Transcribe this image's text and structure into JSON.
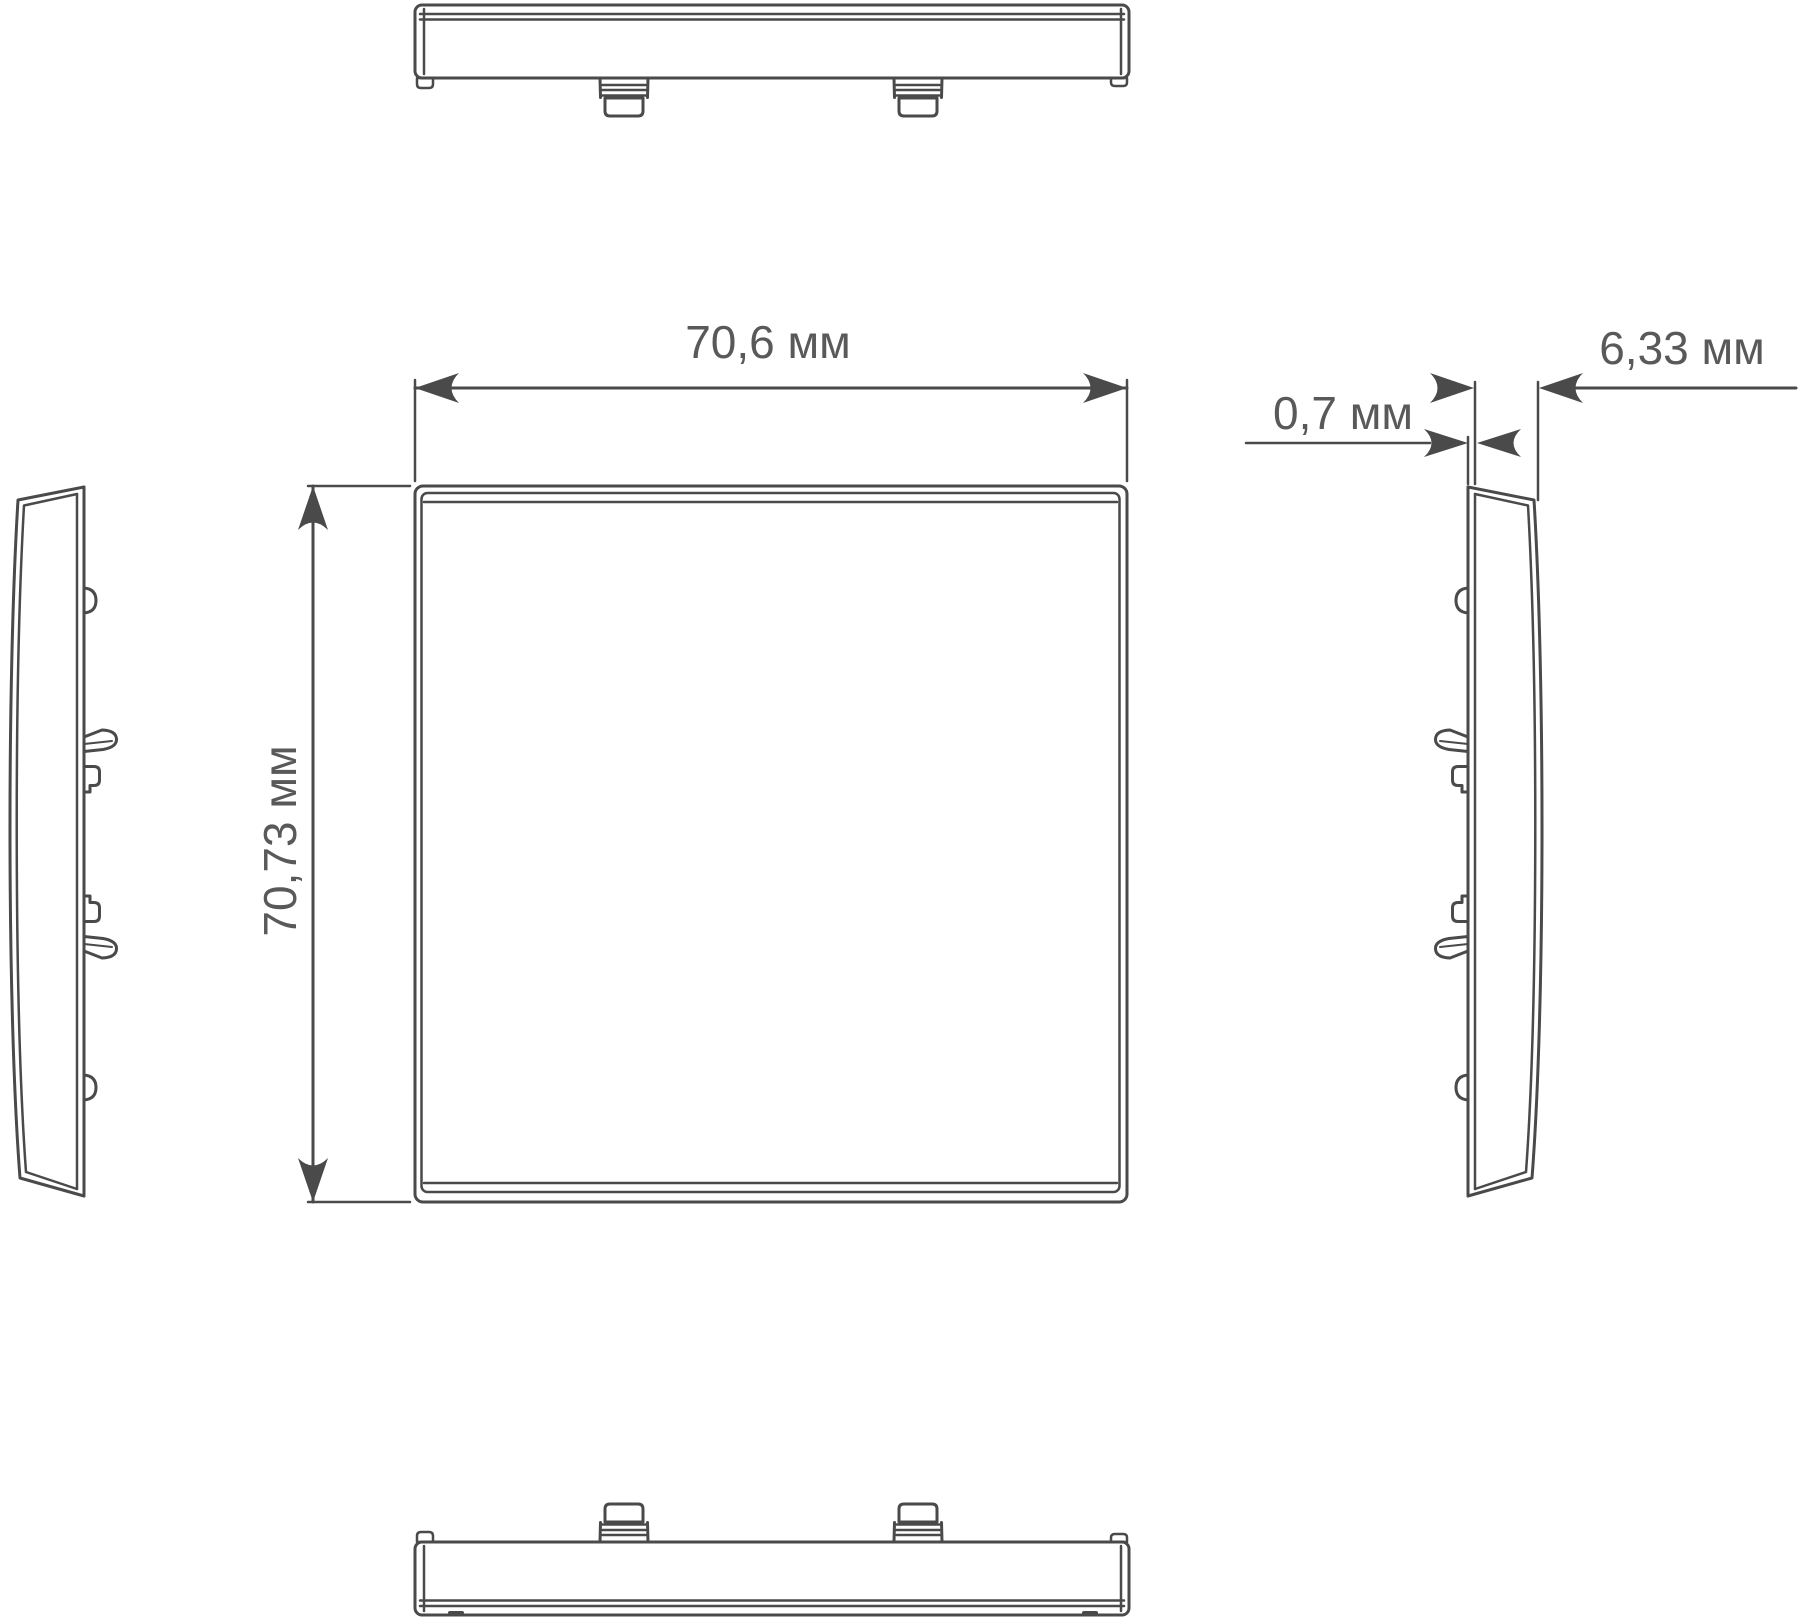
{
  "drawing": {
    "dimensions": {
      "width": {
        "value": "70,6 мм"
      },
      "height": {
        "value": "70,73 мм"
      },
      "front_lip_thickness": {
        "value": "0,7 мм"
      },
      "depth": {
        "value": "6,33 мм"
      }
    },
    "colors": {
      "line": "#4a4a4a",
      "text": "#595959",
      "background": "#ffffff"
    }
  }
}
